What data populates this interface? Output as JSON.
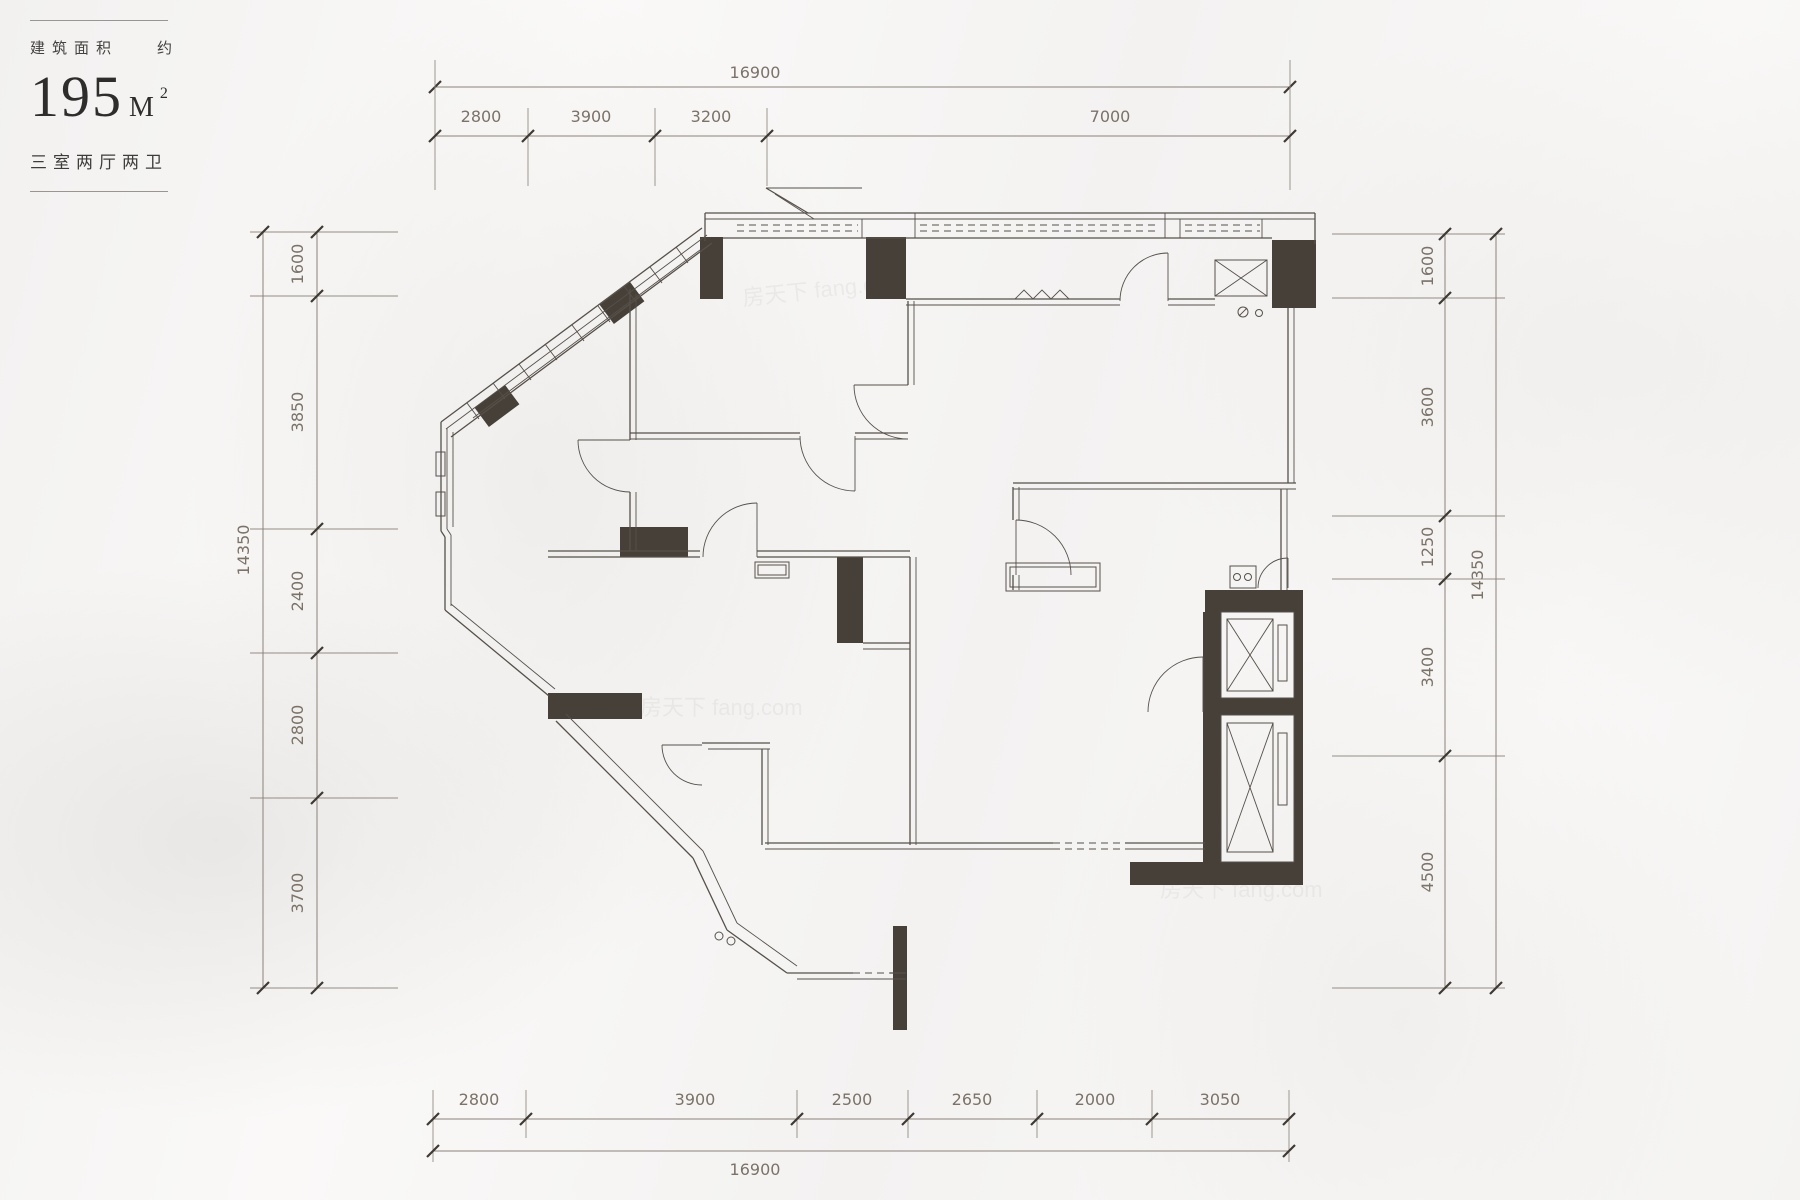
{
  "title_block": {
    "area_caption": "建筑面积",
    "approx": "约",
    "area_number": "195",
    "area_unit": "M",
    "area_exponent": "2",
    "layout_text": "三室两厅两卫"
  },
  "watermark": {
    "text": "房天下 fang.com"
  },
  "dimensions": {
    "top": {
      "y_overall": 87,
      "y_seg": 136,
      "overall_label": "16900",
      "overall_label_x": 755,
      "ticks": [
        435,
        528,
        655,
        767,
        1290
      ],
      "labels": [
        "2800",
        "3900",
        "3200",
        "7000"
      ],
      "label_x": [
        481,
        591,
        711,
        1110
      ]
    },
    "bottom": {
      "y_overall": 1151,
      "y_seg": 1119,
      "overall_label": "16900",
      "overall_label_x": 755,
      "ticks": [
        433,
        526,
        797,
        908,
        1037,
        1152,
        1289
      ],
      "labels": [
        "2800",
        "3900",
        "2500",
        "2650",
        "2000",
        "3050"
      ],
      "label_x": [
        479,
        695,
        852,
        972,
        1095,
        1220
      ]
    },
    "left": {
      "x_overall": 263,
      "x_seg": 317,
      "overall_label": "14350",
      "overall_label_y": 550,
      "ticks": [
        232,
        296,
        529,
        653,
        798,
        988
      ],
      "labels": [
        "1600",
        "3850",
        "2400",
        "2800",
        "3700"
      ],
      "label_y": [
        264,
        412,
        591,
        725,
        893
      ]
    },
    "right": {
      "x_overall": 1496,
      "x_seg": 1445,
      "overall_label": "14350",
      "overall_label_y": 575,
      "ticks": [
        234,
        298,
        516,
        579,
        756,
        988
      ],
      "labels": [
        "1600",
        "3600",
        "1250",
        "3400",
        "4500"
      ],
      "label_y": [
        266,
        407,
        547,
        667,
        872
      ]
    }
  }
}
